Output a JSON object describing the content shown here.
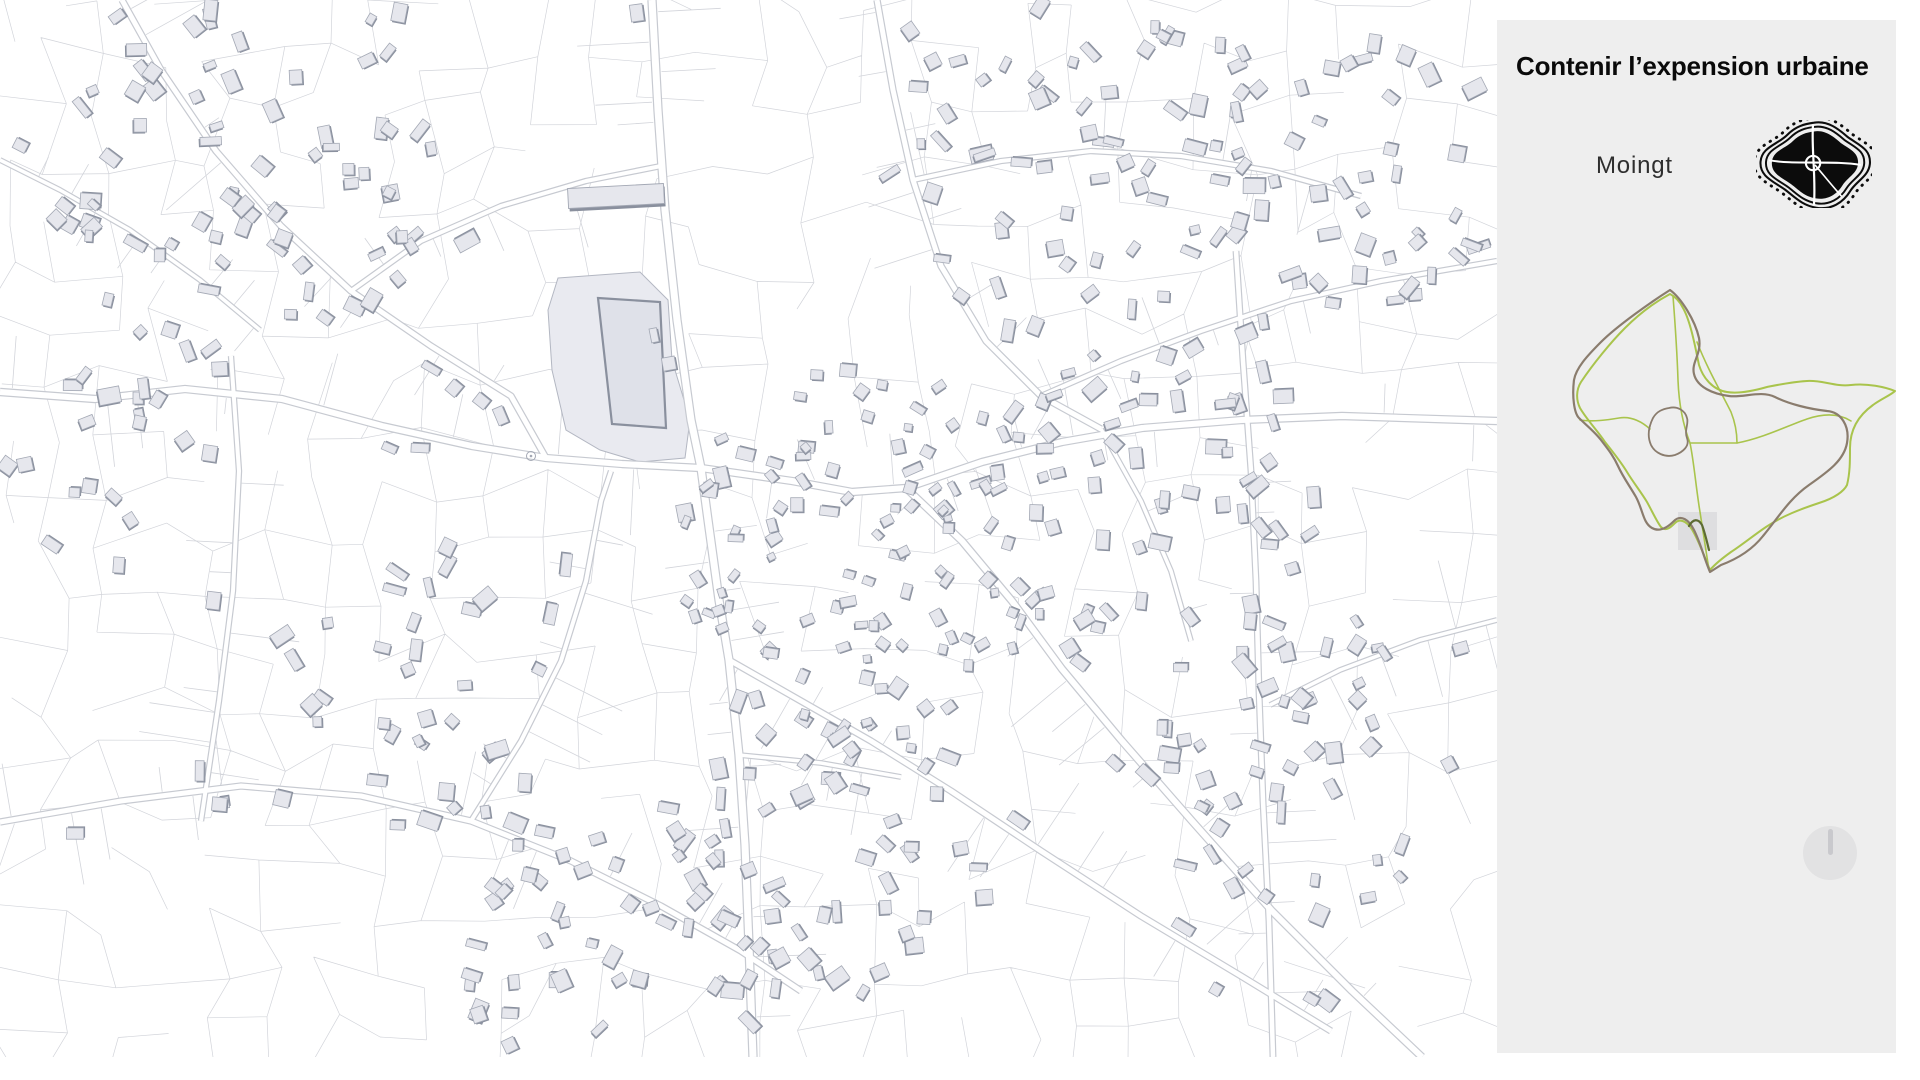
{
  "panel": {
    "title": "Contenir l’expension urbaine",
    "commune_label": "Moingt"
  },
  "colors": {
    "page_bg": "#ffffff",
    "panel_bg": "#eeeeee",
    "title_color": "#0a0a0a",
    "label_color": "#2e2e2e",
    "parcel_line": "#d2d4da",
    "road_edge": "#c7cad1",
    "road_fill": "#ffffff",
    "building_fill": "#e6e7ed",
    "building_edge": "#a3a8b4",
    "building_shadow": "#8a909e",
    "site_fill": "#e9eaf0",
    "boundary_old": "#8a7c6d",
    "boundary_new": "#a9c44c",
    "boundary_overlap": "#5d6b33",
    "viewport_square": "#dedee0",
    "blob_icon": "#0c0c0c",
    "dial_bg": "#e2e2e3",
    "dial_pointer": "#c9c9cd"
  }
}
